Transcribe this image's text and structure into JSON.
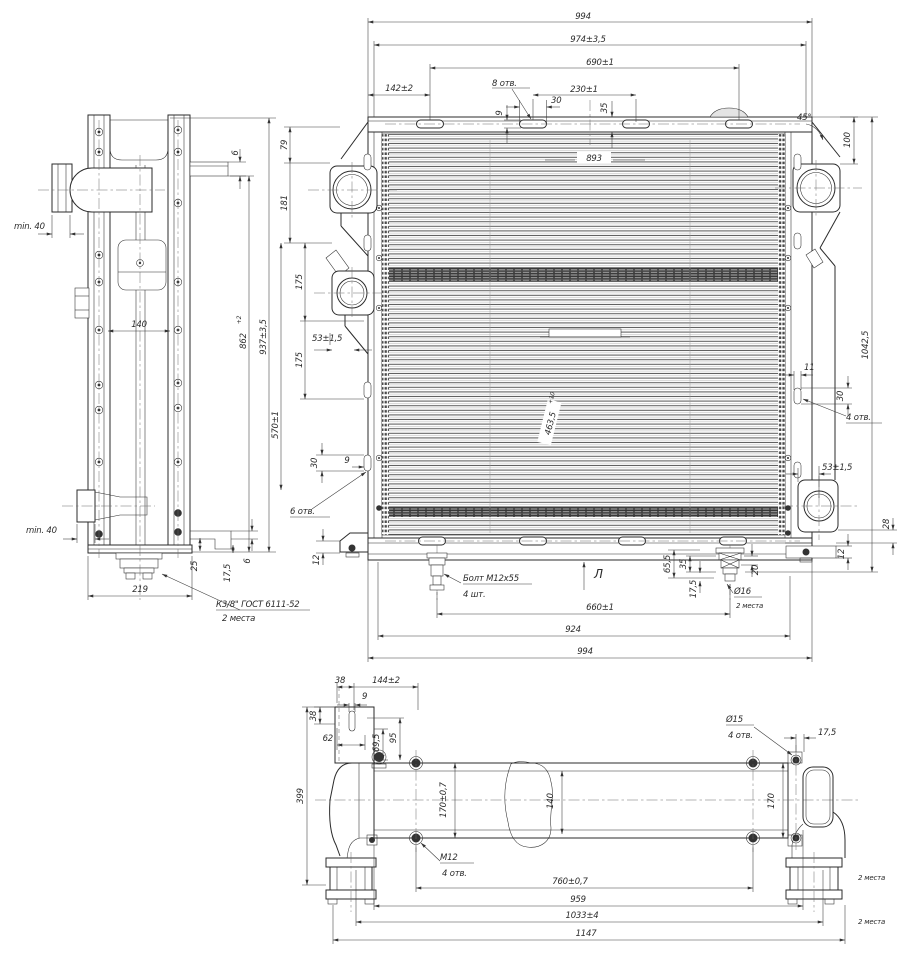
{
  "side": {
    "min40_top": "min. 40",
    "bracket_thk_top": "6",
    "rail_width": "140",
    "height_core": "862",
    "height_core_tol": "+2",
    "height_overall": "937±3,5",
    "min40_bottom": "min. 40",
    "d25": "25",
    "d17_5": "17,5",
    "bracket_thk_bottom": "6",
    "depth": "219",
    "thread_note_line1": "К3/8\" ГОСТ 6111-52",
    "thread_note_line2": "2 места"
  },
  "front": {
    "top": {
      "d994": "994",
      "d974": "974±3,5",
      "d690": "690±1",
      "d142": "142±2",
      "holes8": "8 отв.",
      "d30": "30",
      "d9": "9",
      "d230": "230±1",
      "d35": "35"
    },
    "left": {
      "d79": "79",
      "d181": "181",
      "d175a": "175",
      "d175b": "175",
      "d53": "53±1,5",
      "d570": "570±1",
      "d30": "30",
      "d9": "9",
      "holes6": "6 отв.",
      "d12": "12"
    },
    "right": {
      "angle45": "45°",
      "d100": "100",
      "d11": "11",
      "d30": "30",
      "holes4": "4 отв.",
      "d53": "53±1,5",
      "d1042": "1042,5",
      "d28": "28",
      "d12": "12"
    },
    "core": {
      "width": "893",
      "mid": "463,5",
      "mid_tol": "+10"
    },
    "bottom": {
      "bolt_note1": "Болт М12х55",
      "bolt_note2": "4 шт.",
      "d65": "65,5",
      "d35": "35",
      "d17": "17,5",
      "d20": "20",
      "dia16": "Ø16",
      "places2": "2 места",
      "d660": "660±1",
      "d924": "924",
      "d994": "994",
      "view_label": "Л"
    }
  },
  "bottomview": {
    "d38a": "38",
    "d144": "144±2",
    "d9": "9",
    "d38b": "38",
    "d62": "62",
    "d69": "69,5",
    "d95": "95",
    "d399": "399",
    "d170l": "170±0,7",
    "d140": "140",
    "m12": "М12",
    "m12_holes": "4 отв.",
    "dia15": "Ø15",
    "dia15_holes": "4 отв.",
    "d17": "17,5",
    "d170r": "170",
    "d760": "760±0,7",
    "d959": "959",
    "d1033": "1033±4",
    "d1147": "1147",
    "places2a": "2 места",
    "places2b": "2 места"
  }
}
